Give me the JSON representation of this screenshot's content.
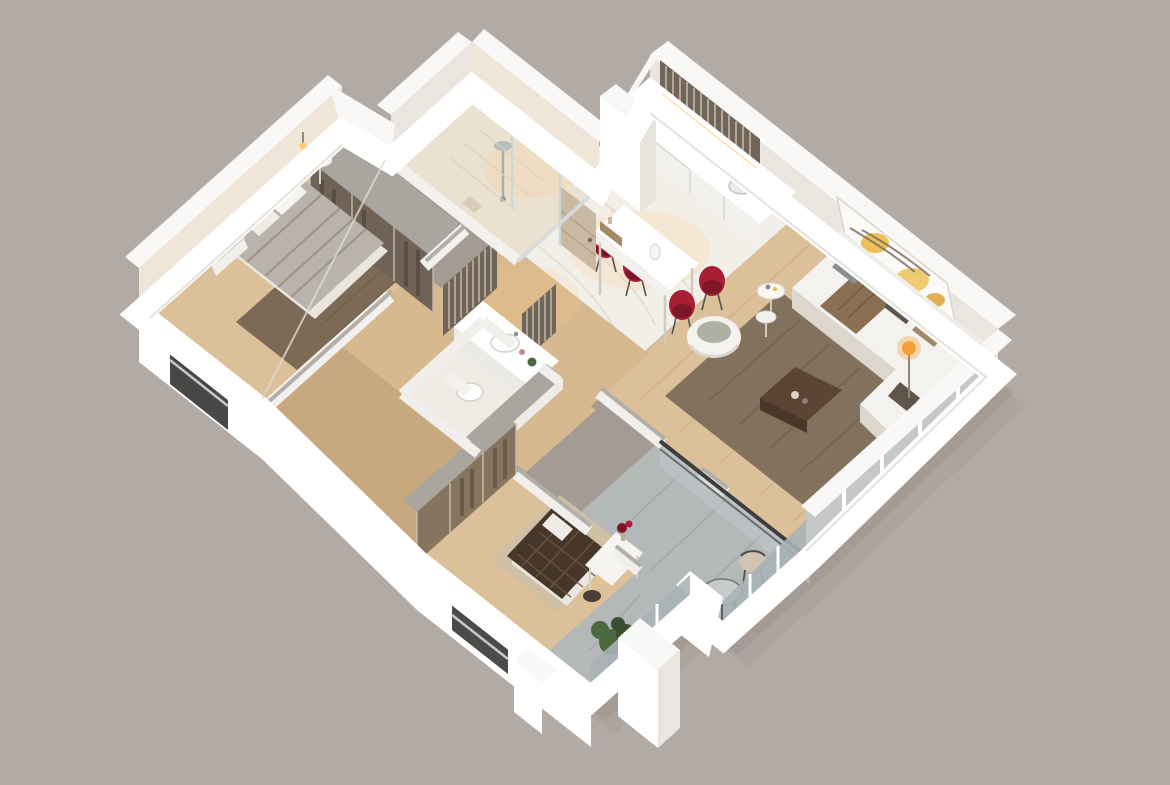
{
  "canvas": {
    "width": 1170,
    "height": 785,
    "background": "#b2aaa4"
  },
  "scene": {
    "kind": "isometric-3d-apartment-floor-plan-render",
    "style": "photorealistic cutaway model, white walls, warm interior lighting",
    "rooms": [
      {
        "id": "kitchen-dining",
        "furniture": [
          "l-shaped-white-counter",
          "dark-cooktop",
          "louver-backsplash",
          "white-bar-table",
          "four-red-chairs",
          "marble-floor"
        ]
      },
      {
        "id": "living-room",
        "furniture": [
          "white-l-sofa",
          "brown-throw",
          "gray-tan-pillows",
          "white-armchair",
          "round-nesting-side-tables",
          "dark-wood-coffee-table",
          "abstract-art-canvas",
          "floor-lamp-warm-glow",
          "brown-rug",
          "glass-window-wall"
        ]
      },
      {
        "id": "entry-hall",
        "furniture": [
          "tan-front-door",
          "wood-shelf-with-vase",
          "bronze-louver-partitions",
          "tall-white-wall-slab"
        ]
      },
      {
        "id": "shower-bathroom",
        "furniture": [
          "glass-shower-screen",
          "chrome-shower-head",
          "beige-tile-floor"
        ]
      },
      {
        "id": "master-bedroom",
        "furniture": [
          "bed-gray-striped-duvet",
          "white-pillows",
          "smoked-glass-wardrobe",
          "round-table-fire-bowl",
          "wall-sconce",
          "brown-shag-rug",
          "white-radiator",
          "sw-window"
        ]
      },
      {
        "id": "second-bathroom",
        "furniture": [
          "white-vanity-basin",
          "toilet",
          "small-green-plant",
          "gray-wall-cap"
        ]
      },
      {
        "id": "second-bedroom",
        "furniture": [
          "bed-dark-checkered-blanket",
          "bronze-glass-wardrobe",
          "white-desk",
          "red-flower-vase",
          "dark-stool",
          "beige-rug",
          "south-window"
        ]
      },
      {
        "id": "balcony",
        "furniture": [
          "glass-balustrade",
          "dark-top-rail",
          "beige-chair",
          "round-glass-table",
          "potted-green-plant",
          "white-pillar",
          "concrete-floor"
        ]
      }
    ]
  },
  "palette": {
    "bg": "#b2aaa4",
    "shadow": "#5f564c",
    "wallTop": "#f9f8f6",
    "wallOuter": "#ffffff",
    "wallOuterSoft": "#f3f1ee",
    "wallInner": "#eae5de",
    "wallInnerWarm": "#f0e6d8",
    "grayTop": "#b2aeA9",
    "grayCap": "#a9a59f",
    "marble": "#f2efe9",
    "marbleVein": "#e2dbce",
    "wood": "#dcc099",
    "woodDark": "#c8a87e",
    "corridorWood": "#d7b98f",
    "rugLiving": "#82715d",
    "rugLivingDark": "#6d5c49",
    "rugBeige": "#cfbfa5",
    "rugMaster": "#7c6a56",
    "sofa": "#f4f2ee",
    "sofaShade": "#dcd6cd",
    "throw": "#8a6f52",
    "pillowDark": "#5e564a",
    "pillowTan": "#a3876a",
    "pillowGray": "#8c8d91",
    "tableWood": "#5c4534",
    "red": "#a81e35",
    "redDark": "#7f1628",
    "artYellow": "#eab63d",
    "artStroke": "#6f6a60",
    "lampGlow": "#f2a23c",
    "flame": "#e87c2b",
    "smokeGlass": "#6f6256",
    "bronzeGlass": "#85755f",
    "bronzeLight": "#cbbda6",
    "slatDark": "#70655a",
    "slatLight": "#c6b8a1",
    "glassPane": "#c2c9cc",
    "glassDeep": "#a9b2b6",
    "mullion": "#ffffff",
    "railDark": "#3d3d3d",
    "balconyFloor": "#b5b8b9",
    "balconyDark": "#9b9fa0",
    "plant": "#4c6840",
    "plantDark": "#38502f",
    "pot": "#8d8d89",
    "door": "#c9b8a2",
    "doorShade": "#b5a38c",
    "tile": "#ebe1d1",
    "chrome": "#b9bcbe",
    "duvet": "#b9b3ab",
    "duvetStripe": "#948c82",
    "blanket": "#46372a",
    "blanketGrid": "#6a553e",
    "deskWhite": "#f6f4f0",
    "warmLight": "#ffca7a"
  }
}
